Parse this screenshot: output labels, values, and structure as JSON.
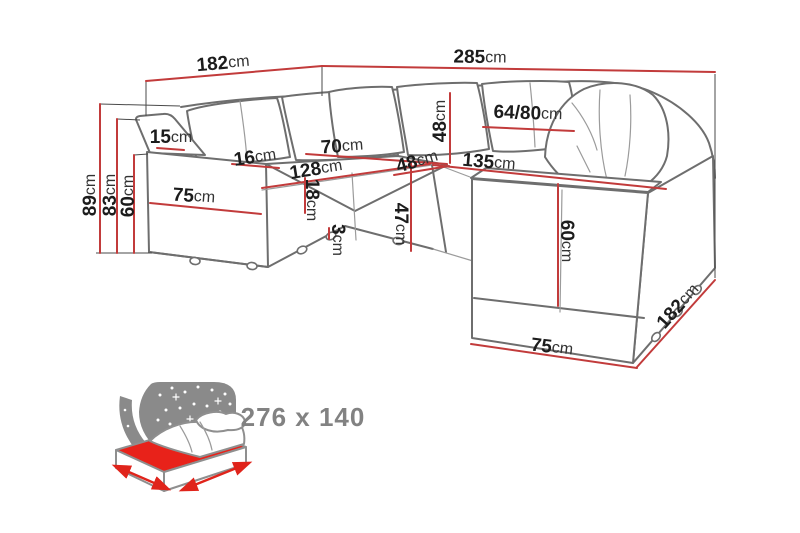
{
  "unit": "cm",
  "colors": {
    "dimension_line": "#c23b3b",
    "sofa_outline": "#6e6e6e",
    "label_text": "#1c1c1c",
    "icon_gray": "#8a8a8a",
    "icon_red": "#e8221a",
    "background": "#ffffff"
  },
  "dimensions": {
    "top_width_left": "182",
    "top_width_right": "285",
    "total_height": "89",
    "backrest_height": "83",
    "arm_height_left": "60",
    "armrest_thickness": "15",
    "armrest_depth": "16",
    "seat_depth_left": "70",
    "seat_length_left": "128",
    "seat_thickness": "18",
    "leg_height": "3",
    "back_cushion_height": "48",
    "corner_seat_width": "48",
    "seat_height": "47",
    "pillow_width": "64/80",
    "seat_length_right": "135",
    "arm_panel_height": "60",
    "arm_base_width_right": "75",
    "side_depth_right": "182",
    "arm_front_width_left": "75"
  },
  "sleeping_area": {
    "label": "276 x 140"
  }
}
